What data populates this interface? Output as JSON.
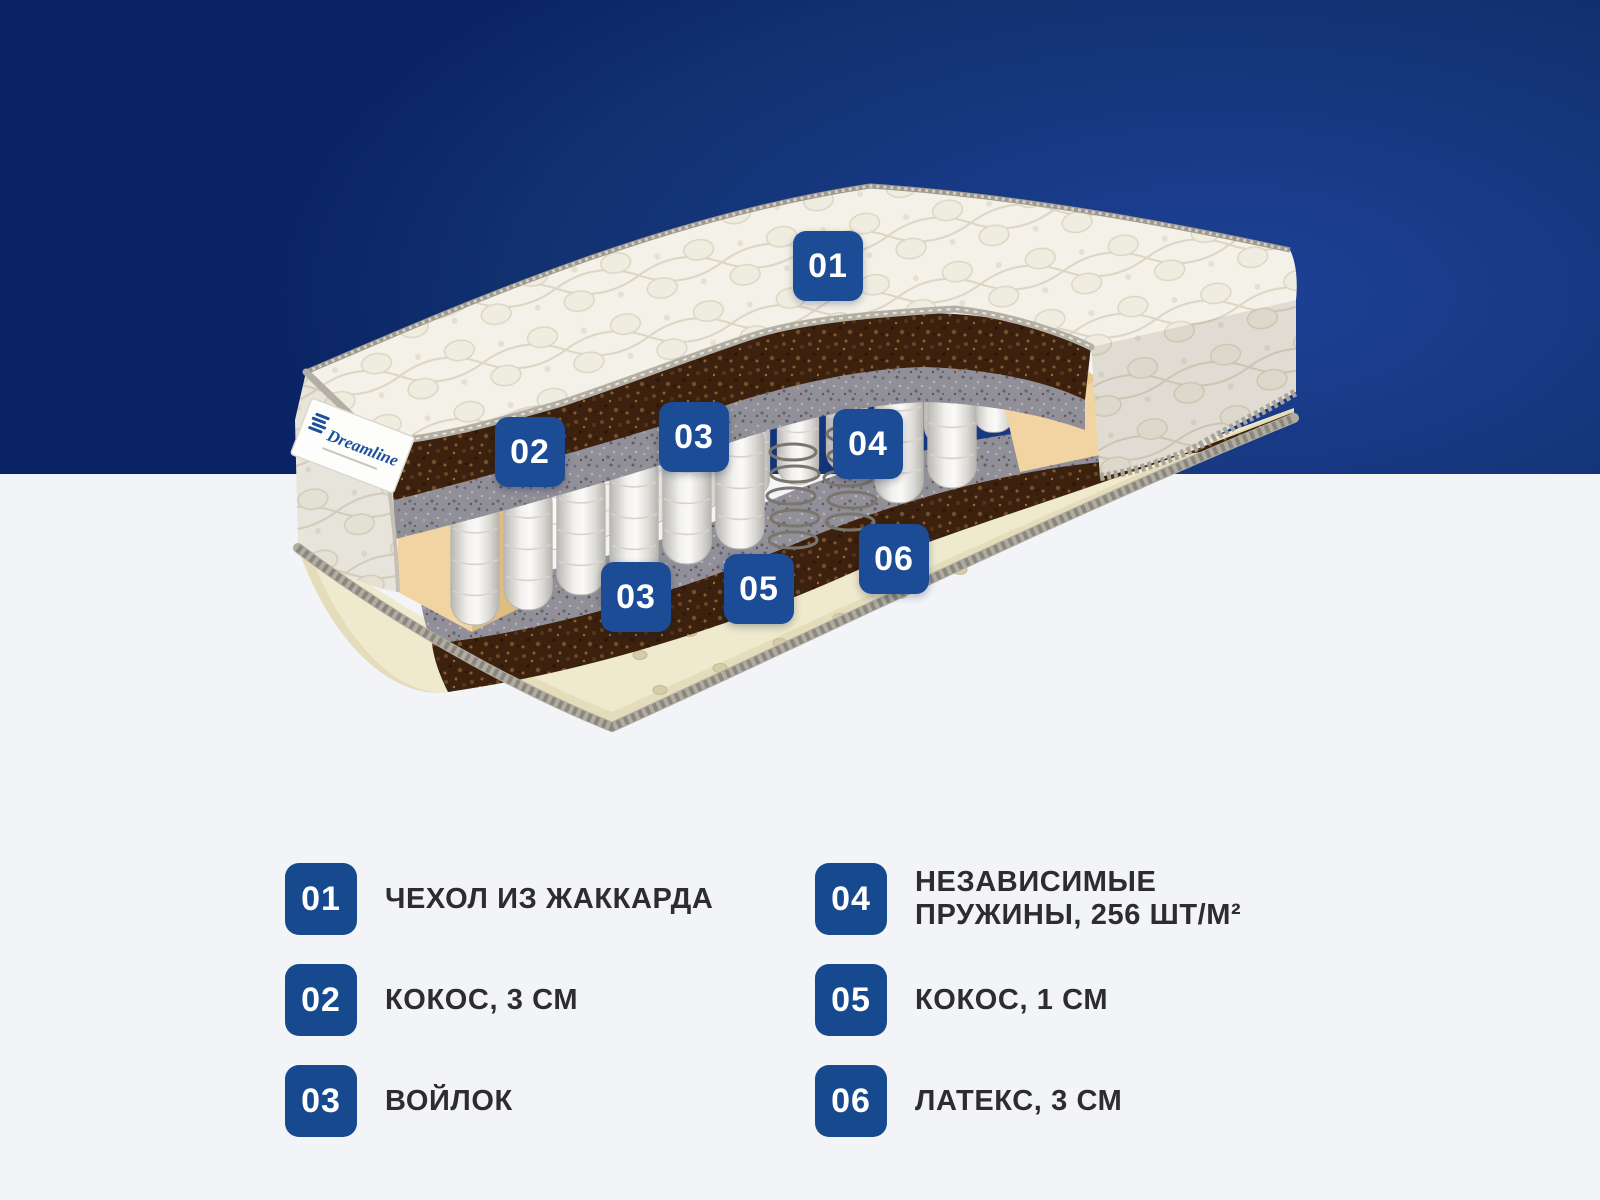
{
  "brand": {
    "name": "Dreamline"
  },
  "background": {
    "top_band_bright": "#1e4196",
    "top_band_dark": "#0a2364",
    "bottom_color": "#f3f4f8"
  },
  "diagram": {
    "badge_color": "#1d4c97",
    "badges": [
      {
        "num": "01"
      },
      {
        "num": "02"
      },
      {
        "num": "03"
      },
      {
        "num": "04"
      },
      {
        "num": "03"
      },
      {
        "num": "05"
      },
      {
        "num": "06"
      }
    ]
  },
  "legend": {
    "number_color": "#17498f",
    "items": [
      {
        "num": "01",
        "lines": [
          "ЧЕХОЛ ИЗ ЖАККАРДА"
        ]
      },
      {
        "num": "02",
        "lines": [
          "КОКОС, 3 СМ"
        ]
      },
      {
        "num": "03",
        "lines": [
          "ВОЙЛОК"
        ]
      },
      {
        "num": "04",
        "lines": [
          "НЕЗАВИСИМЫЕ",
          "ПРУЖИНЫ, 256 ШТ/М²"
        ]
      },
      {
        "num": "05",
        "lines": [
          "КОКОС, 1 СМ"
        ]
      },
      {
        "num": "06",
        "lines": [
          "ЛАТЕКС, 3 СМ"
        ]
      }
    ]
  }
}
